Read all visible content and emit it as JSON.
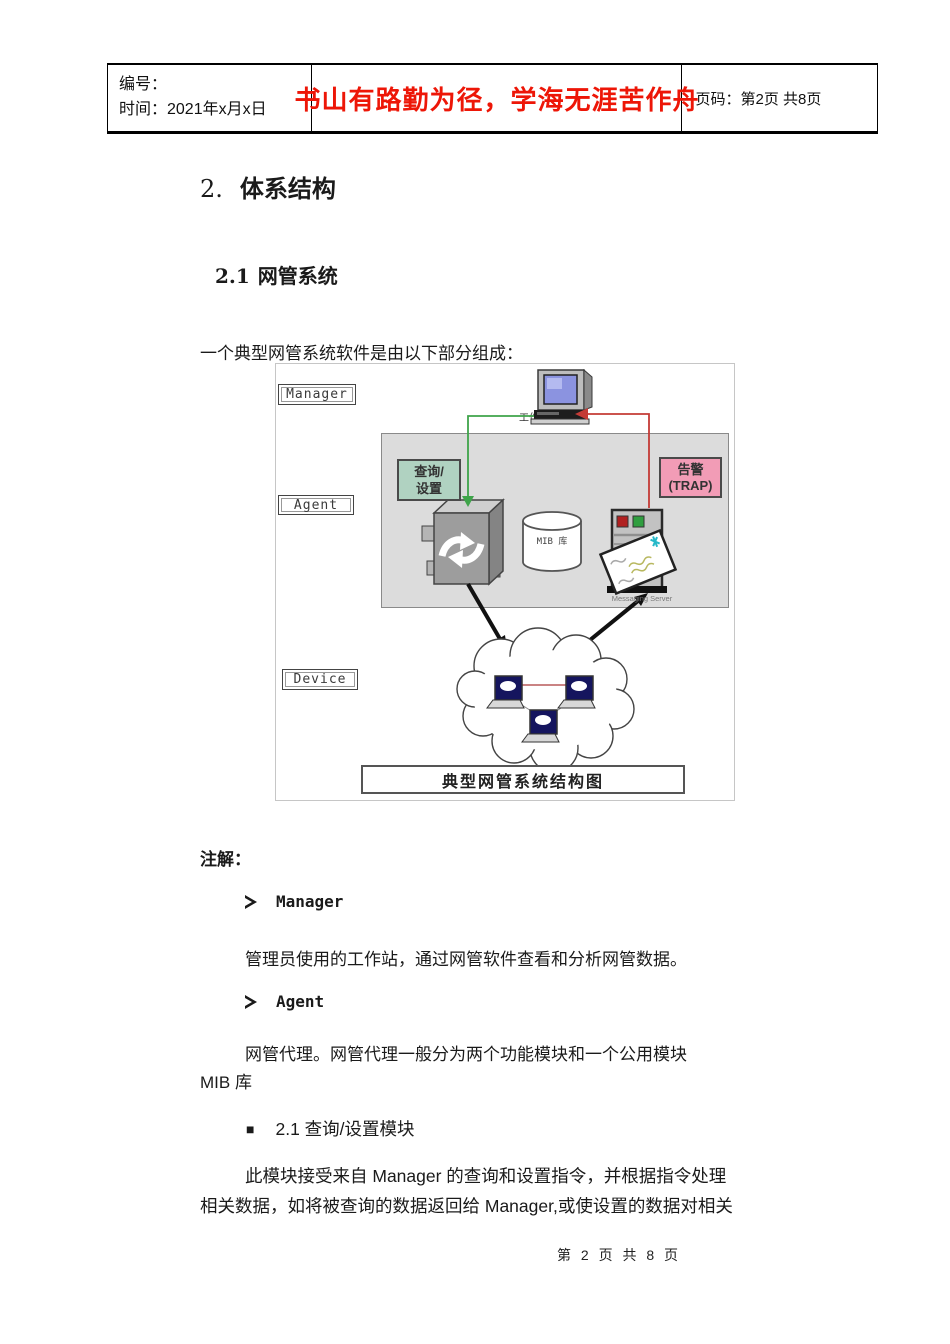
{
  "header": {
    "number_label": "编号：",
    "time_label": "时间：2021年x月x日",
    "slogan": "书山有路勤为径，学海无涯苦作舟",
    "slogan_color": "#ed1607",
    "page_label": "页码：第2页 共8页"
  },
  "body": {
    "title_number": "2.",
    "title_text": "体系结构",
    "section_number": "2.1",
    "section_text": "网管系统",
    "intro": "一个典型网管系统软件是由以下部分组成：",
    "notes_label": "注解：",
    "bullet1_term": "Manager",
    "bullet1_desc": "管理员使用的工作站，通过网管软件查看和分析网管数据。",
    "bullet2_term": "Agent",
    "bullet2_desc": "网管代理。网管代理一般分为两个功能模块和一个公用模块\nMIB 库",
    "sub_marker": "■",
    "sub_label": "2.1 查询/设置模块",
    "sub_desc": "此模块接受来自 Manager 的查询和设置指令，并根据指令处理\n相关数据，如将被查询的数据返回给 Manager,或使设置的数据对相关"
  },
  "diagram": {
    "label_manager": "Manager",
    "label_agent": "Agent",
    "label_device": "Device",
    "workstation_label": "工作站",
    "query_line1": "查询/",
    "query_line2": "设置",
    "trap_line1": "告警",
    "trap_line2": "(TRAP)",
    "mib_label": "MIB 库",
    "server_label": "Messaging Server",
    "caption": "典型网管系统结构图",
    "colors": {
      "query_fill": "#b0d2c1",
      "trap_fill": "#f29cb6",
      "agent_area_fill": "#dcdcdc",
      "query_arrow_green": "#3fa44a",
      "trap_arrow_red": "#c43b36",
      "laptop_screen": "#15155e",
      "envelope_mark_cyan": "#25b8c8"
    }
  },
  "footer": {
    "page_info": "第 2 页 共 8 页"
  }
}
